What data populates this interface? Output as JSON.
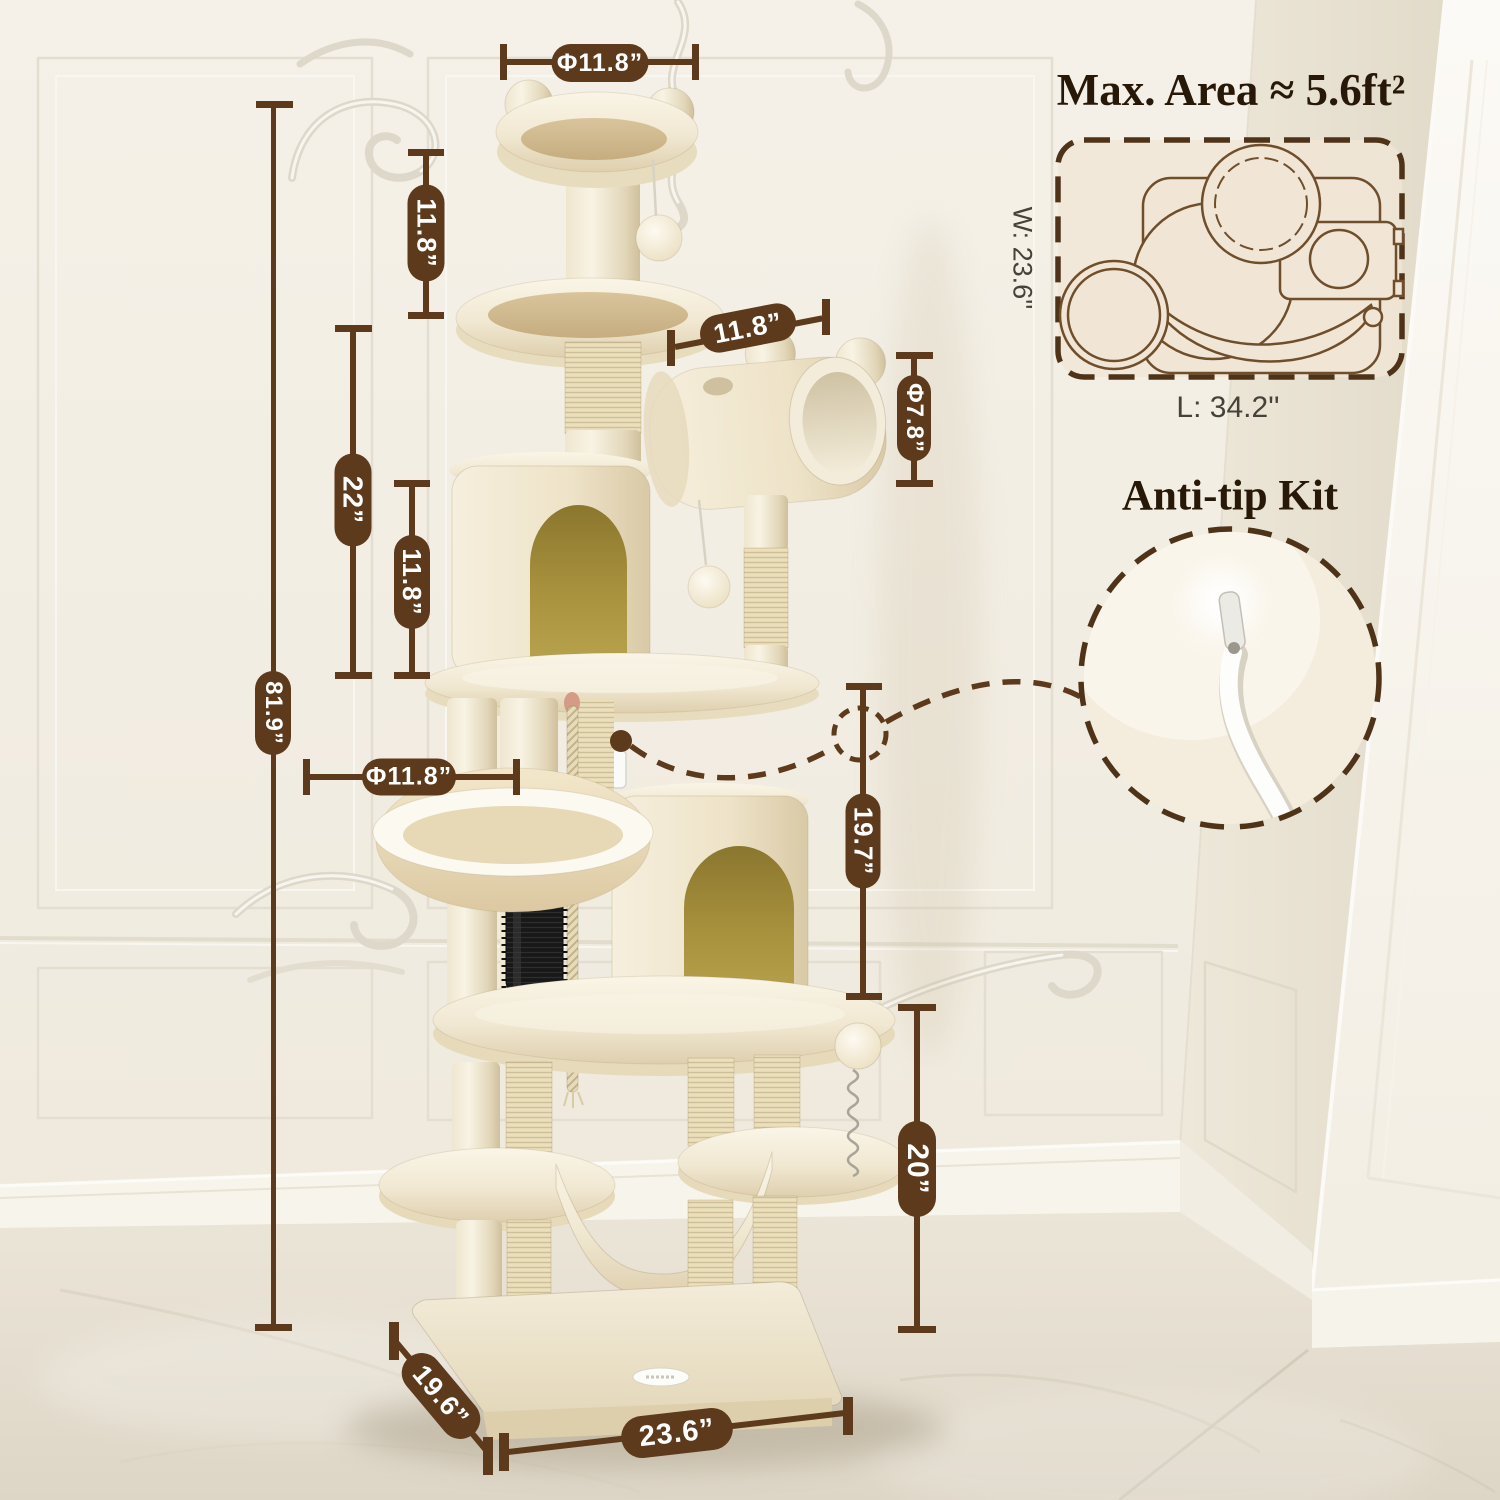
{
  "scene": {
    "subject": "cat tree dimension diagram",
    "accent_color": "#5d3a1b",
    "title_color": "#271807",
    "plush_color": "#f2e9d4",
    "condo_interior_color": "#a8913d"
  },
  "dims": {
    "top_perch_diameter": "Φ11.8”",
    "top_section_height": "11.8”",
    "upper_section_height": "22”",
    "condo_height": "11.8”",
    "total_height": "81.9”",
    "basket_diameter": "Φ11.8”",
    "tunnel_length": "11.8”",
    "tunnel_diameter": "Φ7.8”",
    "mid_section_height": "19.7”",
    "lower_section_height": "20”",
    "base_depth": "19.6”",
    "base_width": "23.6”"
  },
  "max_area": {
    "title": "Max. Area ≈ 5.6ft²",
    "width_label": "W: 23.6''",
    "length_label": "L: 34.2''"
  },
  "anti_tip": {
    "title": "Anti-tip Kit"
  }
}
